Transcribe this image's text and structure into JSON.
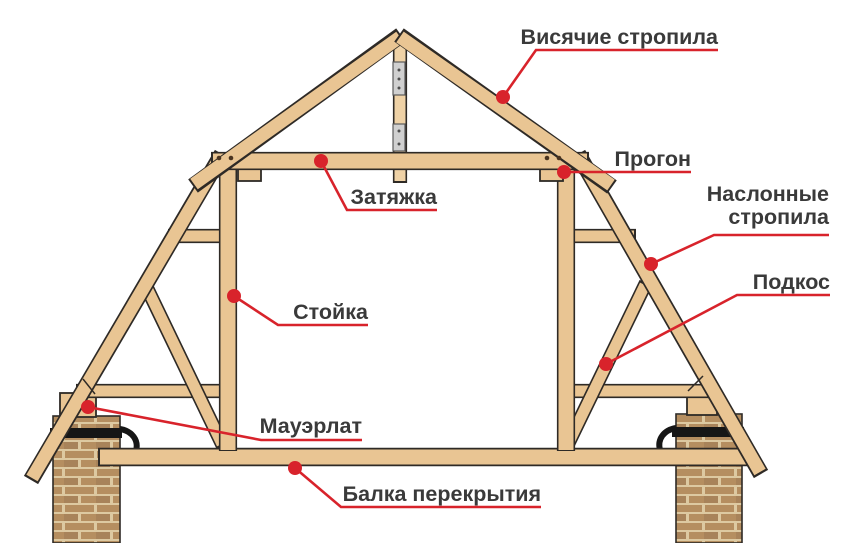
{
  "diagram_title": "Mansard roof truss structure (labeled parts)",
  "labels": [
    {
      "id": "hanging-rafters",
      "text": "Висячие стропила"
    },
    {
      "id": "purlin",
      "text": "Прогон"
    },
    {
      "id": "tie-beam",
      "text": "Затяжка"
    },
    {
      "id": "inclined-rafters",
      "lines": [
        "Наслонные",
        "стропила"
      ]
    },
    {
      "id": "strut",
      "text": "Подкос"
    },
    {
      "id": "post",
      "text": "Стойка"
    },
    {
      "id": "mauerlat",
      "text": "Мауэрлат"
    },
    {
      "id": "floor-beam",
      "text": "Балка перекрытия"
    }
  ],
  "colors": {
    "wood": "#e9c593",
    "wood_light": "#efd2a6",
    "outline": "#2e2a26",
    "red": "#d8232b",
    "label": "#3a3a3a",
    "plate": "#d0d0d0",
    "clamp": "#161616",
    "brick_a": "#b58e60",
    "brick_b": "#a8835a",
    "mortar": "#ddc9a1"
  }
}
